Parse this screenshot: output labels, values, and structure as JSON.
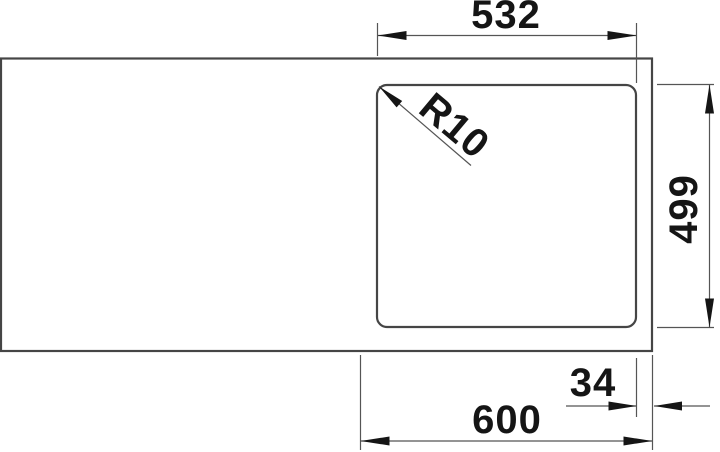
{
  "drawing": {
    "type": "technical-drawing",
    "subject": "sink-top-view",
    "dimensions": [
      {
        "id": "bowl-width",
        "label": "532",
        "value": 532,
        "unit": "mm",
        "orientation": "horizontal-top"
      },
      {
        "id": "corner-radius",
        "label": "R10",
        "value": 10,
        "unit": "mm",
        "orientation": "diagonal-leader"
      },
      {
        "id": "bowl-depth",
        "label": "499",
        "value": 499,
        "unit": "mm",
        "orientation": "vertical-right"
      },
      {
        "id": "edge-offset",
        "label": "34",
        "value": 34,
        "unit": "mm",
        "orientation": "horizontal-bottom"
      },
      {
        "id": "cabinet-width",
        "label": "600",
        "value": 600,
        "unit": "mm",
        "orientation": "horizontal-bottom"
      }
    ],
    "colors": {
      "background": "#ffffff",
      "outline": "#454545",
      "dimension_line": "#555555",
      "ink": "#151515"
    }
  }
}
